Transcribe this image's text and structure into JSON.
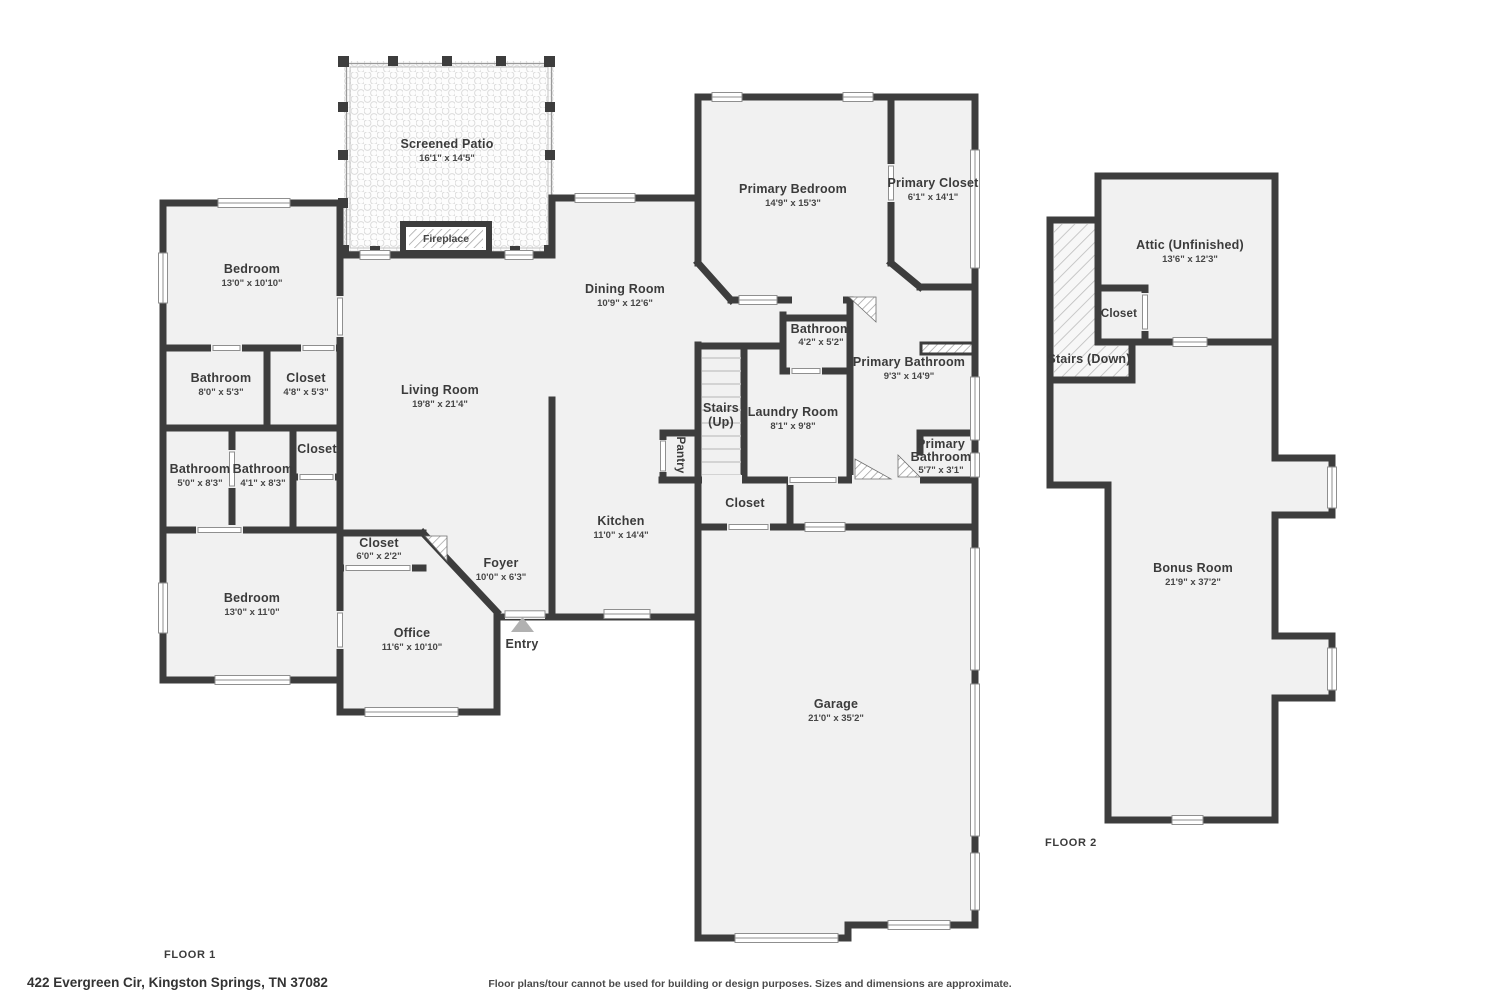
{
  "page": {
    "floor1_label": "FLOOR 1",
    "floor2_label": "FLOOR 2",
    "address": "422 Evergreen Cir, Kingston Springs, TN 37082",
    "disclaimer": "Floor plans/tour cannot be used for building or design purposes. Sizes and dimensions are approximate."
  },
  "colors": {
    "wall": "#3d3d3d",
    "floor_fill": "#f1f1f1",
    "text": "#3b3b3b",
    "entry_marker": "#b1b1b1"
  },
  "floor1": {
    "screened_patio": {
      "name": "Screened Patio",
      "dims": "16'1\" x 14'5\""
    },
    "fireplace": {
      "name": "Fireplace"
    },
    "bedroom_top": {
      "name": "Bedroom",
      "dims": "13'0\" x 10'10\""
    },
    "bathroom_top": {
      "name": "Bathroom",
      "dims": "8'0\" x 5'3\""
    },
    "closet_top": {
      "name": "Closet",
      "dims": "4'8\" x 5'3\""
    },
    "bathroom_left": {
      "name": "Bathroom",
      "dims": "5'0\" x 8'3\""
    },
    "bathroom_mid": {
      "name": "Bathroom",
      "dims": "4'1\" x 8'3\""
    },
    "closet_mid": {
      "name": "Closet"
    },
    "bedroom_bottom": {
      "name": "Bedroom",
      "dims": "13'0\" x 11'0\""
    },
    "closet_office": {
      "name": "Closet",
      "dims": "6'0\" x 2'2\""
    },
    "office": {
      "name": "Office",
      "dims": "11'6\" x 10'10\""
    },
    "living_room": {
      "name": "Living Room",
      "dims": "19'8\" x 21'4\""
    },
    "dining_room": {
      "name": "Dining Room",
      "dims": "10'9\" x 12'6\""
    },
    "kitchen": {
      "name": "Kitchen",
      "dims": "11'0\" x 14'4\""
    },
    "foyer": {
      "name": "Foyer",
      "dims": "10'0\" x 6'3\""
    },
    "entry": {
      "name": "Entry"
    },
    "pantry": {
      "name": "Pantry"
    },
    "stairs_up": {
      "name": "Stairs",
      "name2": "(Up)"
    },
    "laundry": {
      "name": "Laundry Room",
      "dims": "8'1\" x 9'8\""
    },
    "bathroom_small": {
      "name": "Bathroom",
      "dims": "4'2\" x 5'2\""
    },
    "primary_bedroom": {
      "name": "Primary Bedroom",
      "dims": "14'9\" x 15'3\""
    },
    "primary_closet": {
      "name": "Primary Closet",
      "dims": "6'1\" x 14'1\""
    },
    "primary_bathroom": {
      "name": "Primary Bathroom",
      "dims": "9'3\" x 14'9\""
    },
    "primary_wc": {
      "name": "Primary",
      "name2": "Bathroom",
      "dims": "5'7\" x 3'1\""
    },
    "closet_hall": {
      "name": "Closet"
    },
    "garage": {
      "name": "Garage",
      "dims": "21'0\" x 35'2\""
    }
  },
  "floor2": {
    "attic": {
      "name": "Attic (Unfinished)",
      "dims": "13'6\" x 12'3\""
    },
    "closet": {
      "name": "Closet"
    },
    "stairs_down": {
      "name": "Stairs (Down)"
    },
    "bonus_room": {
      "name": "Bonus Room",
      "dims": "21'9\" x 37'2\""
    }
  }
}
